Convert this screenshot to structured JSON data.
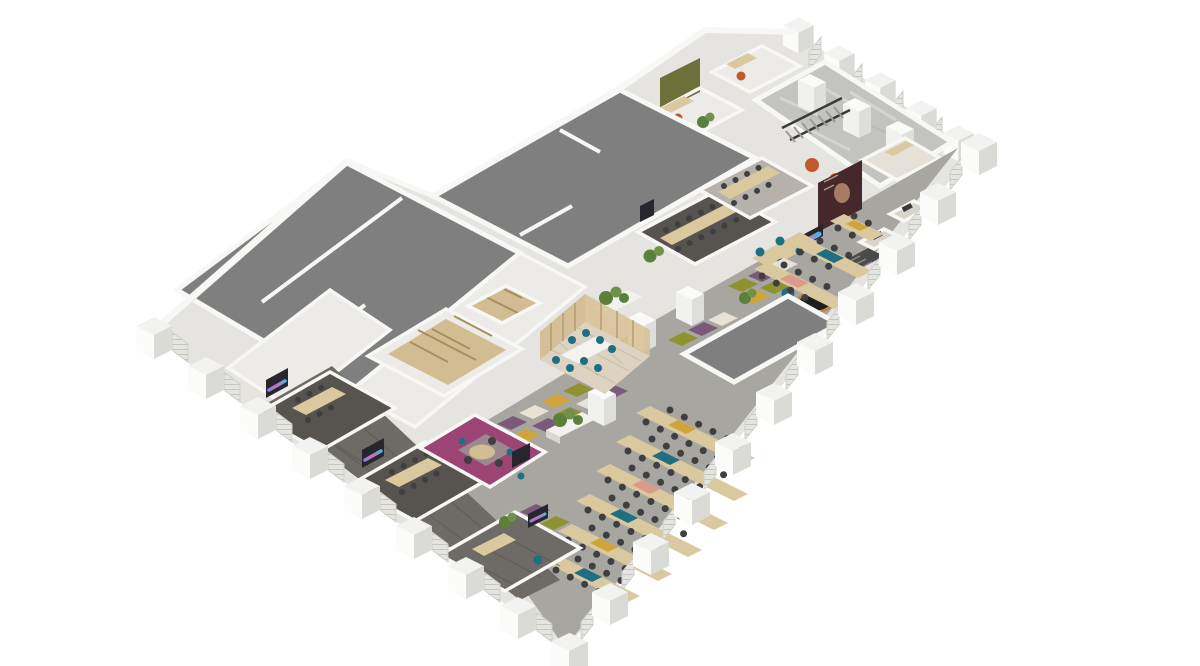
{
  "image": {
    "kind": "3d-isometric-office-floorplan-render",
    "background": "#ffffff",
    "description": "Aerial cutaway 3D render of a chevron-shaped office floor: bare grey core-and-shell slabs on the upper-left wing, fitted-out offices along the lower-right band with open-plan desking, meeting rooms, a magenta project room, timber pods, raw concrete terrace with stairs at top right, and castellated white facade piers with louvre panels around the perimeter.",
    "visible_text": []
  },
  "palette": {
    "bg": "#ffffff",
    "base": "#e6e4e0",
    "slab": "#7f7f7f",
    "wall": "#f7f7f5",
    "wallShade": "#dcdcd8",
    "floorLight": "#edebe7",
    "floorDark": "#57534e",
    "plank": "#6e6a65",
    "wood": "#d2bc92",
    "woodDark": "#a98e5f",
    "desk": "#dac89f",
    "carpet": "#a7a6a1",
    "olive": "#8f9230",
    "purple": "#7b5a79",
    "mustard": "#cfa43b",
    "cream": "#e8e2d4",
    "tileGray": "#c9c7c0",
    "magenta": "#9c4574",
    "teal": "#1f6f83",
    "chair": "#3f3f41",
    "plant": "#5d7f3c",
    "plant2": "#6f9149",
    "marble": "#c3c3bf",
    "orange": "#c2592b",
    "oliveWall": "#6d7139",
    "poster": "#46282a",
    "screen": "#26262c",
    "glassFloor": "#ddd3c2"
  },
  "areas": [
    {
      "name": "shell-core-slabs",
      "floor": "bare concrete grey"
    },
    {
      "name": "raw-marble-space",
      "floor": "marble/concrete with columns and stair void"
    },
    {
      "name": "open-plan-desking",
      "floor": "grey carpet with olive/purple/cream accent tiles"
    },
    {
      "name": "perimeter-meeting-rooms",
      "floor": "dark carpet, timber tables, wall screens"
    },
    {
      "name": "magenta-project-room",
      "floor": "magenta carpet, round table"
    },
    {
      "name": "glass-meeting-room",
      "floor": "patterned tile, white table, teal chairs"
    },
    {
      "name": "timber-pod-block",
      "floor": "plywood partitions"
    },
    {
      "name": "collaboration-zone",
      "floor": "media screen, round dark table, teal seating"
    },
    {
      "name": "focus-booths",
      "floor": "small booths along north-east edge"
    },
    {
      "name": "private-offices-north",
      "floor": "olive feature walls, orange chairs"
    },
    {
      "name": "tip-office",
      "floor": "dark timber, desk and lounge chair"
    }
  ],
  "facade": {
    "pier_count_sw": 9,
    "pier_count_se": 11,
    "pier_count_ne": 5,
    "infill": "louvre panels"
  }
}
